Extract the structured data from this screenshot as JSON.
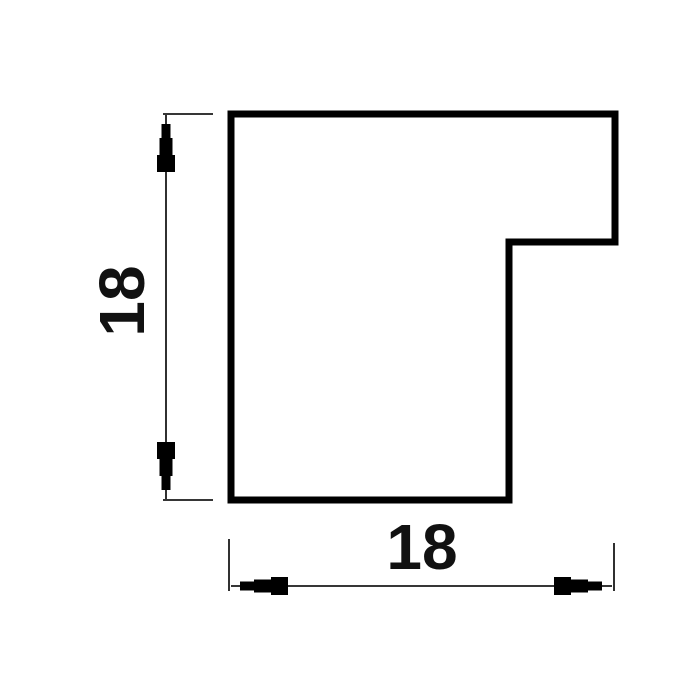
{
  "drawing": {
    "kind": "profile-cross-section-dimension-drawing",
    "colors": {
      "background": "#ffffff",
      "outline": "#000000",
      "dimension_lines": "#1a1a1a",
      "label_text": "#111111"
    },
    "vertical_dimension": {
      "label": "18"
    },
    "horizontal_dimension": {
      "label": "18"
    }
  }
}
